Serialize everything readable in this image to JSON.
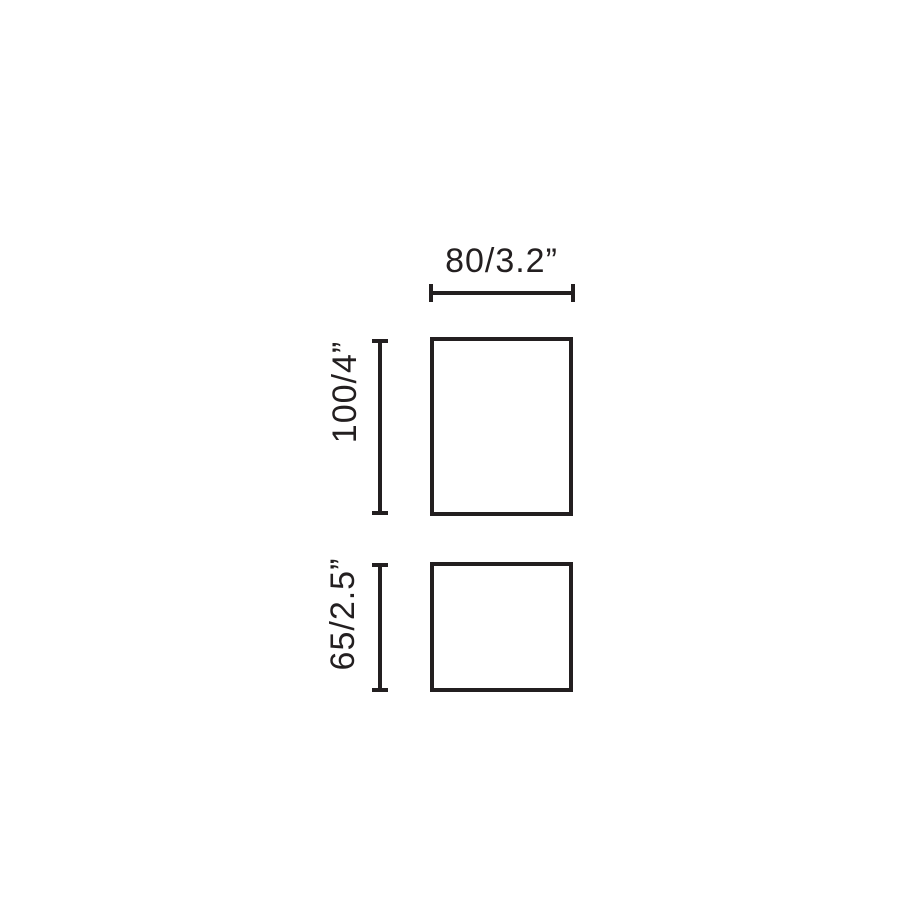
{
  "colors": {
    "line": "#231f20",
    "background": "#ffffff"
  },
  "diagram": {
    "type": "product-dimension-drawing",
    "dimensions": {
      "top_width": {
        "label": "80/3.2”",
        "millimeters": 80,
        "inches": 3.2,
        "applies_to": "upper-rectangle",
        "orientation": "horizontal"
      },
      "upper_height": {
        "label": "100/4”",
        "millimeters": 100,
        "inches": 4,
        "applies_to": "upper-rectangle",
        "orientation": "vertical"
      },
      "lower_height": {
        "label": "65/2.5”",
        "millimeters": 65,
        "inches": 2.5,
        "applies_to": "lower-rectangle",
        "orientation": "vertical"
      }
    }
  }
}
